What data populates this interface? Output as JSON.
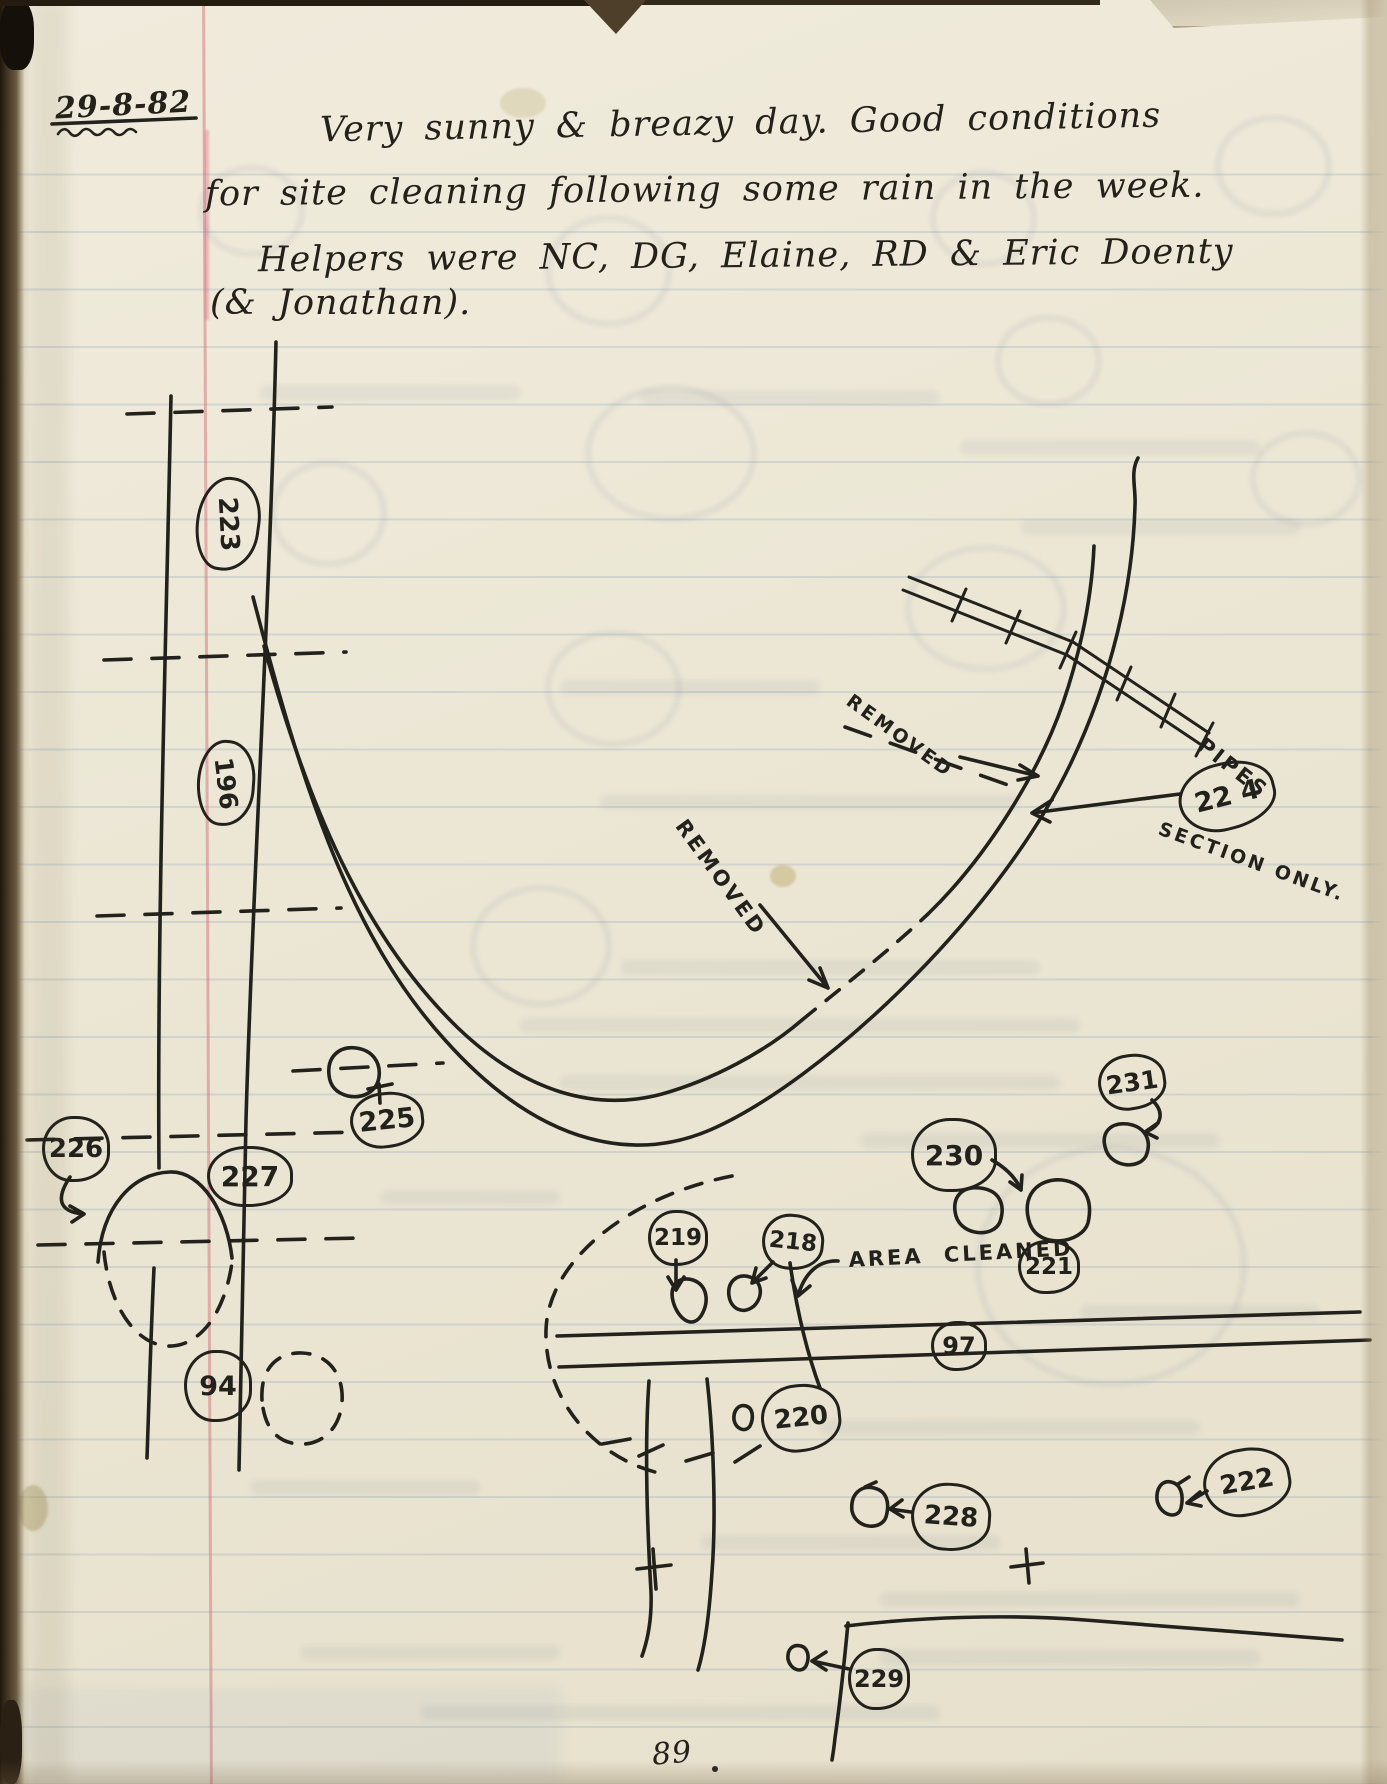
{
  "page": {
    "date": "29-8-82",
    "page_number": "89",
    "notes": {
      "line1": "Very sunny & breazy day.  Good conditions",
      "line2": "for site cleaning following some rain in the week.",
      "line3": "Helpers were NC, DG, Elaine, RD & Eric Doenty",
      "line4": "(& Jonathan)."
    }
  },
  "diagram": {
    "annotations": {
      "removed_upper": "REMOVED",
      "removed_lower": "REMOVED",
      "pipes": "PIPES",
      "section_only": "SECTION ONLY.",
      "area_cleaned": "AREA CLEANED"
    },
    "feature_labels": [
      {
        "id": "223",
        "text": "223"
      },
      {
        "id": "196",
        "text": "196"
      },
      {
        "id": "225",
        "text": "225"
      },
      {
        "id": "226",
        "text": "226"
      },
      {
        "id": "227",
        "text": "227"
      },
      {
        "id": "94",
        "text": "94"
      },
      {
        "id": "224",
        "text": "22 4"
      },
      {
        "id": "231",
        "text": "231"
      },
      {
        "id": "230",
        "text": "230"
      },
      {
        "id": "219",
        "text": "219"
      },
      {
        "id": "218",
        "text": "218"
      },
      {
        "id": "221",
        "text": "221"
      },
      {
        "id": "97",
        "text": "97"
      },
      {
        "id": "220",
        "text": "220"
      },
      {
        "id": "228",
        "text": "228"
      },
      {
        "id": "222",
        "text": "222"
      },
      {
        "id": "229",
        "text": "229"
      }
    ]
  },
  "colors": {
    "paper": "#ece7d5",
    "ink": "#23211c",
    "rule_blue": "#7a98b6",
    "margin_red": "#d4626e"
  }
}
